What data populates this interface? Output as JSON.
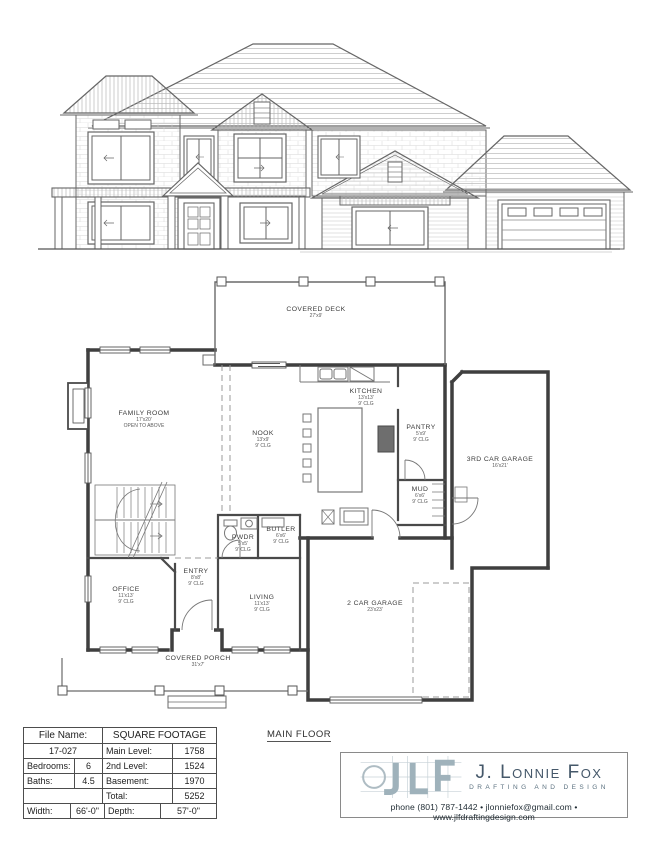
{
  "plan": {
    "title": "MAIN FLOOR",
    "rooms": [
      {
        "name": "COVERED DECK",
        "dim": "27'x9'"
      },
      {
        "name": "FAMILY ROOM",
        "dim": "17'x20'",
        "note": "OPEN TO ABOVE"
      },
      {
        "name": "KITCHEN",
        "dim": "13'x13'",
        "clg": "9' CLG"
      },
      {
        "name": "NOOK",
        "dim": "13'x9'",
        "clg": "9' CLG"
      },
      {
        "name": "PANTRY",
        "dim": "5'x9'",
        "clg": "9' CLG"
      },
      {
        "name": "3RD CAR GARAGE",
        "dim": "16'x21'"
      },
      {
        "name": "MUD",
        "dim": "6'x6'",
        "clg": "9' CLG"
      },
      {
        "name": "PWDR",
        "dim": "5'x5'",
        "clg": "9' CLG"
      },
      {
        "name": "BUTLER",
        "dim": "6'x6'",
        "clg": "9' CLG"
      },
      {
        "name": "OFFICE",
        "dim": "11'x13'",
        "clg": "9' CLG"
      },
      {
        "name": "ENTRY",
        "dim": "8'x8'",
        "clg": "9' CLG"
      },
      {
        "name": "LIVING",
        "dim": "11'x13'",
        "clg": "9' CLG"
      },
      {
        "name": "2 CAR GARAGE",
        "dim": "23'x23'"
      },
      {
        "name": "COVERED PORCH",
        "dim": "31'x7'"
      }
    ]
  },
  "title_block": {
    "file_name_label": "File Name:",
    "file_name": "17-027",
    "sqft_header": "SQUARE FOOTAGE",
    "main_level_label": "Main Level:",
    "main_level": "1758",
    "second_level_label": "2nd Level:",
    "second_level": "1524",
    "basement_label": "Basement:",
    "basement": "1970",
    "total_label": "Total:",
    "total": "5252",
    "bedrooms_label": "Bedrooms:",
    "bedrooms": "6",
    "baths_label": "Baths:",
    "baths": "4.5",
    "width_label": "Width:",
    "width": "66'-0\"",
    "depth_label": "Depth:",
    "depth": "57'-0\""
  },
  "branding": {
    "logo_letters": "JLF",
    "company": "J. Lonnie Fox",
    "tagline": "DRAFTING AND DESIGN",
    "contact": "phone (801) 787-1442 • jlonniefox@gmail.com • www.jlfdraftingdesign.com",
    "accent_color": "#9fb2bb",
    "text_color": "#45586a"
  }
}
